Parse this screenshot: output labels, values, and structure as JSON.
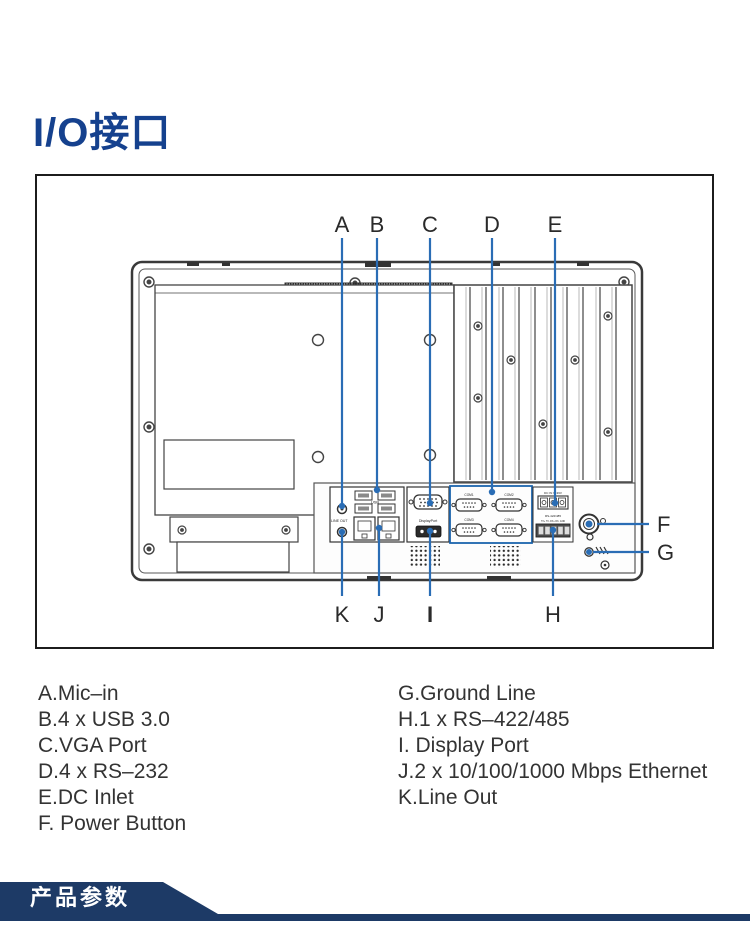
{
  "page": {
    "background": "#ffffff"
  },
  "header": {
    "title": "I/O接口",
    "title_color": "#15418e"
  },
  "diagram": {
    "accent_color": "#2a6db5",
    "highlight_box_color": "#1c64ad",
    "callouts": {
      "top": [
        "A",
        "B",
        "C",
        "D",
        "E"
      ],
      "bottom": [
        "K",
        "J",
        "I",
        "H"
      ],
      "right": [
        "F",
        "G"
      ]
    },
    "port_labels": {
      "usb": "USB",
      "line_out": "LINE OUT",
      "displayport": "DisplayPort",
      "com1": "COM1",
      "com2": "COM2",
      "com3": "COM3",
      "com4": "COM4",
      "dc_inlet": "DC IN 9~36V",
      "rs485": "RS-422/485",
      "rs485_pins": "TX+ TX- RX+ RX- GND"
    }
  },
  "legend": {
    "left": [
      "A.Mic–in",
      "B.4 x USB 3.0",
      "C.VGA Port",
      "D.4 x RS–232",
      "E.DC Inlet",
      "F. Power Button"
    ],
    "right": [
      "G.Ground Line",
      "H.1 x RS–422/485",
      "I. Display Port",
      "J.2 x 10/100/1000 Mbps Ethernet",
      "K.Line Out"
    ]
  },
  "footer": {
    "banner_label": "产品参数",
    "banner_color": "#1d3a66"
  }
}
